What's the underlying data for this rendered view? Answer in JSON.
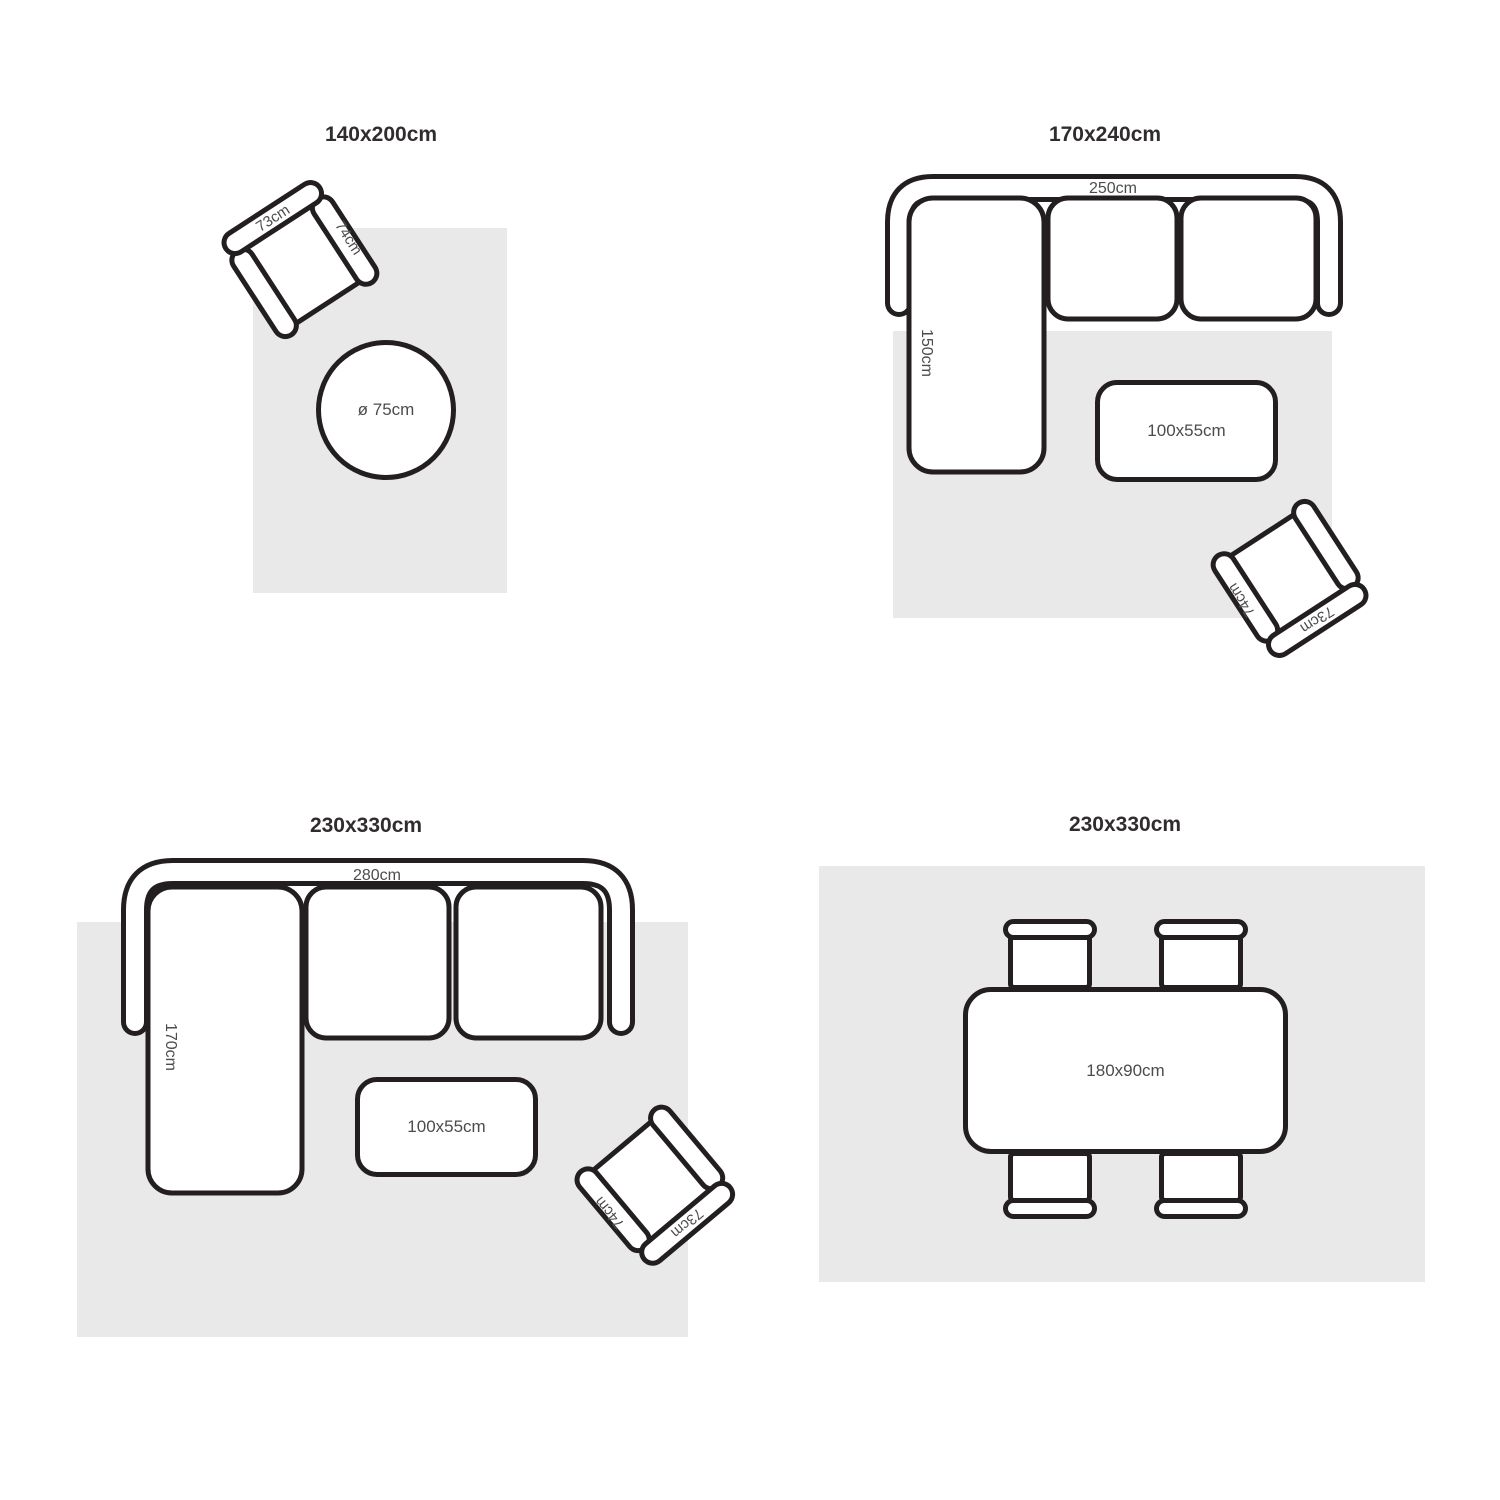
{
  "colors": {
    "line": "#231f20",
    "rug": "#e9e9e9",
    "title_text": "#312d2e",
    "label_text": "#4c4c4c",
    "background": "#ffffff"
  },
  "panels": [
    {
      "title": "140x200cm",
      "armchair": {
        "back": "73cm",
        "arm": "74cm"
      },
      "round_table": {
        "label": "ø 75cm"
      }
    },
    {
      "title": "170x240cm",
      "sofa": {
        "width": "250cm",
        "depth": "150cm"
      },
      "coffee_table": {
        "label": "100x55cm"
      },
      "armchair": {
        "back": "73cm",
        "arm": "74cm"
      }
    },
    {
      "title": "230x330cm",
      "sofa": {
        "width": "280cm",
        "depth": "170cm"
      },
      "coffee_table": {
        "label": "100x55cm"
      },
      "armchair": {
        "back": "73cm",
        "arm": "74cm"
      }
    },
    {
      "title": "230x330cm",
      "dining_table": {
        "label": "180x90cm"
      }
    }
  ]
}
